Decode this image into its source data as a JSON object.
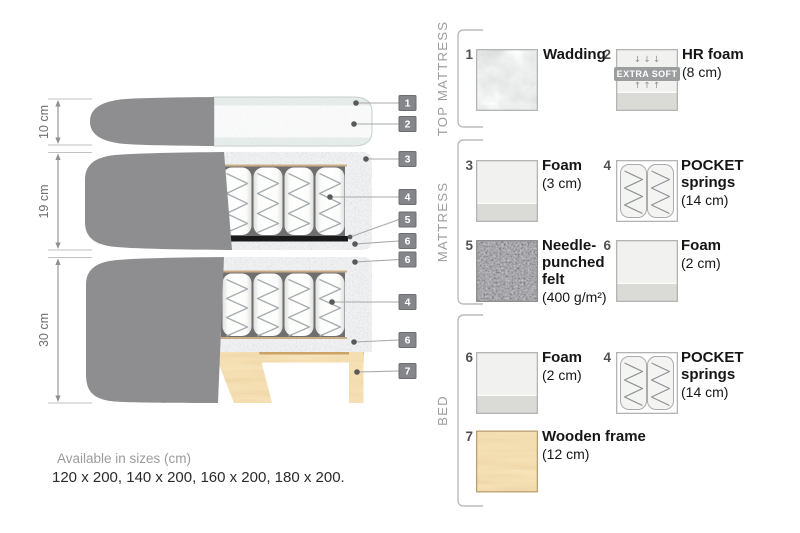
{
  "diagram": {
    "dimensions": [
      {
        "label": "10 cm"
      },
      {
        "label": "19 cm"
      },
      {
        "label": "30 cm"
      }
    ],
    "callouts": [
      {
        "num": "1"
      },
      {
        "num": "2"
      },
      {
        "num": "3"
      },
      {
        "num": "4"
      },
      {
        "num": "5"
      },
      {
        "num": "6"
      },
      {
        "num": "6"
      },
      {
        "num": "4"
      },
      {
        "num": "6"
      },
      {
        "num": "7"
      }
    ]
  },
  "legend": {
    "groups": [
      {
        "title": "TOP MATTRESS"
      },
      {
        "title": "MATTRESS"
      },
      {
        "title": "BED"
      }
    ],
    "items": [
      {
        "num": "1",
        "name": "Wadding",
        "detail": ""
      },
      {
        "num": "2",
        "name": "HR foam",
        "detail": "(8 cm)"
      },
      {
        "num": "3",
        "name": "Foam",
        "detail": "(3 cm)"
      },
      {
        "num": "4",
        "name": "POCKET\nsprings",
        "detail": "(14 cm)"
      },
      {
        "num": "5",
        "name": "Needle-\npunched\nfelt",
        "detail": "(400 g/m²)"
      },
      {
        "num": "6",
        "name": "Foam",
        "detail": "(2 cm)"
      },
      {
        "num": "6",
        "name": "Foam",
        "detail": "(2 cm)"
      },
      {
        "num": "4",
        "name": "POCKET\nsprings",
        "detail": "(14 cm)"
      },
      {
        "num": "7",
        "name": "Wooden frame",
        "detail": "(12 cm)"
      }
    ],
    "extra_soft": {
      "arrows_down": "↓↓↓",
      "badge": "EXTRA SOFT",
      "arrows_up": "↑↑↑"
    }
  },
  "footer": {
    "sizes_heading": "Available in sizes (cm)",
    "sizes_list": "120 x 200, 140 x 200, 160 x 200, 180 x 200."
  },
  "colors": {
    "cover_gray": "#8e8e90",
    "foam_light": "#e6e8e9",
    "wadding_tint": "#e3eae7",
    "felt_dark": "#1a1a1a",
    "wood": "#eac584",
    "chip_bg": "#85868a",
    "muted_text": "#9b9b9b"
  }
}
